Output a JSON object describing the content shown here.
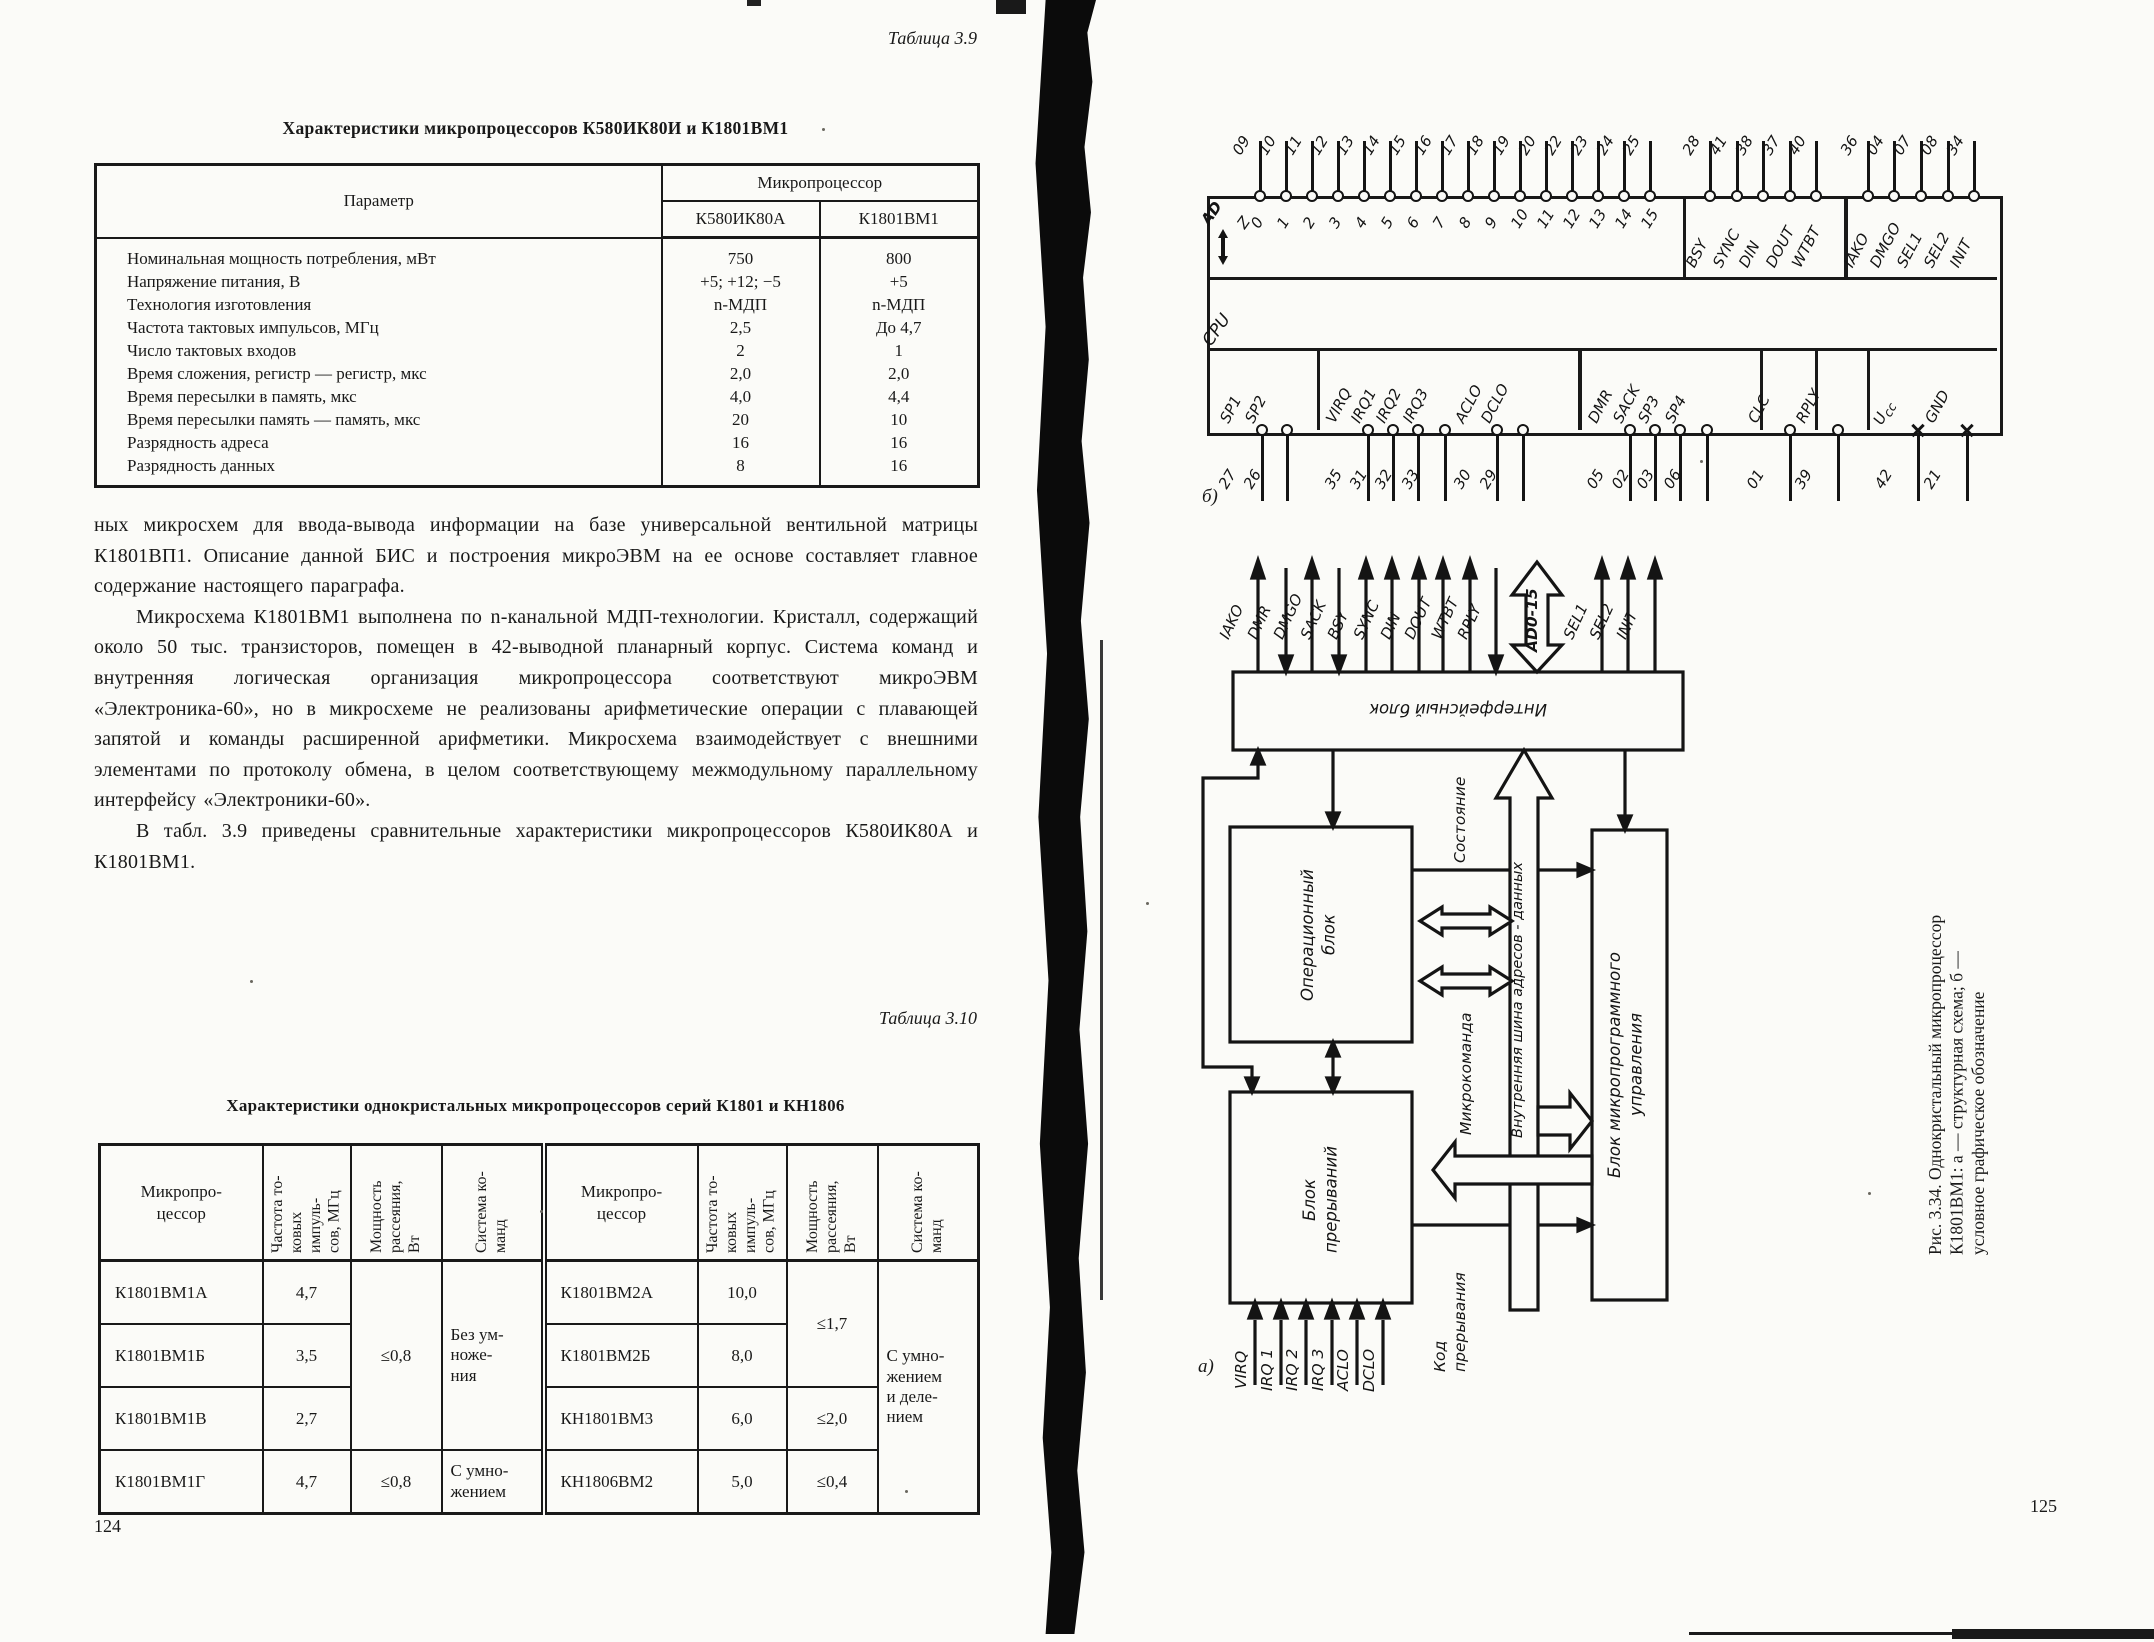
{
  "doc": {
    "left": {
      "caption39": "Таблица 3.9",
      "title39": "Характеристики микропроцессоров К580ИК80И и К1801ВМ1",
      "t39": {
        "col_param": "Параметр",
        "col_group": "Микропроцессор",
        "col_a": "К580ИК80А",
        "col_b": "К1801ВМ1",
        "rows": [
          {
            "p": "Номинальная мощность потребления, мВт",
            "a": "750",
            "b": "800"
          },
          {
            "p": "Напряжение питания, В",
            "a": "+5; +12; −5",
            "b": "+5"
          },
          {
            "p": "Технология изготовления",
            "a": "n-МДП",
            "b": "n-МДП"
          },
          {
            "p": "Частота тактовых импульсов, МГц",
            "a": "2,5",
            "b": "До 4,7"
          },
          {
            "p": "Число тактовых входов",
            "a": "2",
            "b": "1"
          },
          {
            "p": "Время сложения, регистр — регистр, мкс",
            "a": "2,0",
            "b": "2,0"
          },
          {
            "p": "Время пересылки в память, мкс",
            "a": "4,0",
            "b": "4,4"
          },
          {
            "p": "Время пересылки память — память, мкс",
            "a": "20",
            "b": "10"
          },
          {
            "p": "Разрядность адреса",
            "a": "16",
            "b": "16"
          },
          {
            "p": "Разрядность данных",
            "a": "8",
            "b": "16"
          }
        ]
      },
      "para1": "ных микросхем для ввода-вывода информации на базе универсальной вентильной матрицы К1801ВП1. Описание данной БИС и построения микроЭВМ на ее основе составляет главное содержание настоящего параграфа.",
      "para2": "Микросхема К1801ВМ1 выполнена по n-канальной МДП-технологии. Кристалл, содержащий около 50 тыс. транзисторов, помещен в 42-выводной планарный корпус. Система команд и внутренняя логическая организация микропроцессора соответствуют микроЭВМ «Электроника-60», но в микросхеме не реализованы арифметические операции с плавающей запятой и команды расширенной арифметики. Микросхема взаимодействует с внешними элементами по протоколу обмена, в целом соответствующему межмодульному параллельному интерфейсу «Электроники-60».",
      "para3": "В табл. 3.9 приведены сравнительные характеристики микропроцессоров К580ИК80А и К1801ВМ1.",
      "caption310": "Таблица 3.10",
      "title310": "Характеристики однокристальных микропроцессоров серий К1801 и КН1806",
      "t310": {
        "col_mp": "Микропро-\nцессор",
        "col_freq": "Частота то-\nковых импуль-\nсов, МГц",
        "col_pwr": "Мощность\nрассеяния,\nВт",
        "col_sys": "Система ко-\nманд",
        "left_rows": [
          {
            "name": "К1801ВМ1А",
            "freq": "4,7"
          },
          {
            "name": "К1801ВМ1Б",
            "freq": "3,5"
          },
          {
            "name": "К1801ВМ1В",
            "freq": "2,7"
          },
          {
            "name": "К1801ВМ1Г",
            "freq": "4,7",
            "pwr": "≤0,8",
            "sys": "С умно-\nжением"
          }
        ],
        "left_merged": {
          "pwr": "≤0,8",
          "sys": "Без ум-\nноже-\nния"
        },
        "right_rows": [
          {
            "name": "К1801ВМ2А",
            "freq": "10,0"
          },
          {
            "name": "К1801ВМ2Б",
            "freq": "8,0"
          },
          {
            "name": "КН1801ВМ3",
            "freq": "6,0",
            "pwr": "≤2,0"
          },
          {
            "name": "КН1806ВМ2",
            "freq": "5,0",
            "pwr": "≤0,4"
          }
        ],
        "right_merged": {
          "pwr": "≤1,7",
          "sys": "С умно-\nжением\nи деле-\nнием"
        }
      },
      "page_no": "124"
    },
    "right": {
      "pinout": {
        "label": "б)",
        "cpu": "CPU",
        "ad": "AD",
        "z": "Z",
        "ad_pins": [
          {
            "pin": "09",
            "bit": "0"
          },
          {
            "pin": "10",
            "bit": "1"
          },
          {
            "pin": "11",
            "bit": "2"
          },
          {
            "pin": "12",
            "bit": "3"
          },
          {
            "pin": "13",
            "bit": "4"
          },
          {
            "pin": "14",
            "bit": "5"
          },
          {
            "pin": "15",
            "bit": "6"
          },
          {
            "pin": "16",
            "bit": "7"
          },
          {
            "pin": "17",
            "bit": "8"
          },
          {
            "pin": "18",
            "bit": "9"
          },
          {
            "pin": "19",
            "bit": "10"
          },
          {
            "pin": "20",
            "bit": "11"
          },
          {
            "pin": "22",
            "bit": "12"
          },
          {
            "pin": "23",
            "bit": "13"
          },
          {
            "pin": "24",
            "bit": "14"
          },
          {
            "pin": "25",
            "bit": "15"
          }
        ],
        "grp1": [
          {
            "pin": "28",
            "name": "BSY"
          },
          {
            "pin": "41",
            "name": "SYNC"
          },
          {
            "pin": "38",
            "name": "DIN"
          },
          {
            "pin": "37",
            "name": "DOUT"
          },
          {
            "pin": "40",
            "name": "WTBT"
          }
        ],
        "grp2": [
          {
            "pin": "36",
            "name": "IAKO"
          },
          {
            "pin": "04",
            "name": "DMGO"
          },
          {
            "pin": "07",
            "name": "SEL1"
          },
          {
            "pin": "08",
            "name": "SEL2"
          },
          {
            "pin": "34",
            "name": "INIT"
          }
        ],
        "bot": [
          {
            "pin": "27",
            "name": "SP1"
          },
          {
            "pin": "26",
            "name": "SP2"
          },
          {
            "pin": "35",
            "name": "VIRQ"
          },
          {
            "pin": "31",
            "name": "IRQ1"
          },
          {
            "pin": "32",
            "name": "IRQ2"
          },
          {
            "pin": "33",
            "name": "IRQ3"
          },
          {
            "pin": "30",
            "name": "ACLO"
          },
          {
            "pin": "29",
            "name": "DCLO"
          },
          {
            "pin": "05",
            "name": "DMR"
          },
          {
            "pin": "02",
            "name": "SACK"
          },
          {
            "pin": "03",
            "name": "SP3"
          },
          {
            "pin": "06",
            "name": "SP4"
          },
          {
            "pin": "01",
            "name": "CLC"
          },
          {
            "pin": "39",
            "name": "RPLY"
          },
          {
            "pin": "42",
            "name": "U",
            "sub": "cc"
          },
          {
            "pin": "21",
            "name": "GND"
          }
        ]
      },
      "schema": {
        "label": "а)",
        "top_signals": [
          "IAKO",
          "DMR",
          "DMGO",
          "SACK",
          "BSY",
          "SYNC",
          "DIN",
          "DOUT",
          "WTBT",
          "RPLY"
        ],
        "bus_top_label": "AD0-15",
        "right_signals": [
          "SEL1",
          "SEL2",
          "INIT"
        ],
        "blk_interface": "Интерфейсный блок",
        "blk_alu": "Операционный\nблок",
        "blk_irq": "Блок\nпрерываний",
        "blk_mcu": "Блок микропрограммного\nуправления",
        "lbl_state": "Состояние",
        "lbl_mc": "Микрокоманда",
        "lbl_bus": "Внутренняя шина адресов - данных",
        "lbl_irqcode": "Код\nпрерывания",
        "inputs": [
          "VIRQ",
          "IRQ 1",
          "IRQ 2",
          "IRQ 3",
          "ACLO",
          "DCLO"
        ]
      },
      "fig_caption": "Рис. 3.34. Однокристальный микропроцессор\nК1801ВМ1: а — структурная схема; б —\nусловное графическое обозначение",
      "page_no": "125"
    }
  }
}
